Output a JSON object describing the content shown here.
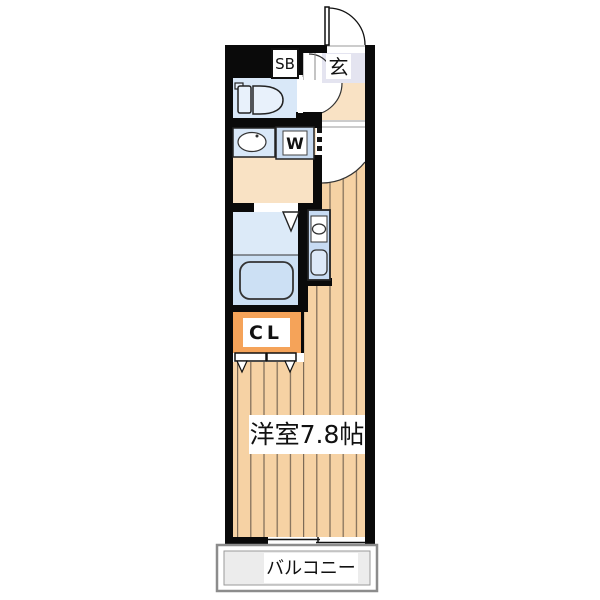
{
  "floorplan": {
    "title": "apartment-floor-plan",
    "labels": {
      "shoe_box": "SB",
      "entrance": "玄",
      "washing_machine": "W",
      "closet": "CL",
      "main_room": "洋室7.8帖",
      "balcony": "バルコニー"
    },
    "colors": {
      "wall": "#0a0a0a",
      "flooring": "#f6d2a4",
      "flooring_line": "#7b6956",
      "water_area_blue": "#d9e8f8",
      "bath_platform_blue": "#cce0f4",
      "kitchen_blue": "#c7dbf3",
      "hall_beige": "#f9e2c4",
      "entrance_lavender": "#e4e4f0",
      "closet_orange": "#f5a359",
      "balcony_gray": "#ececec"
    }
  }
}
